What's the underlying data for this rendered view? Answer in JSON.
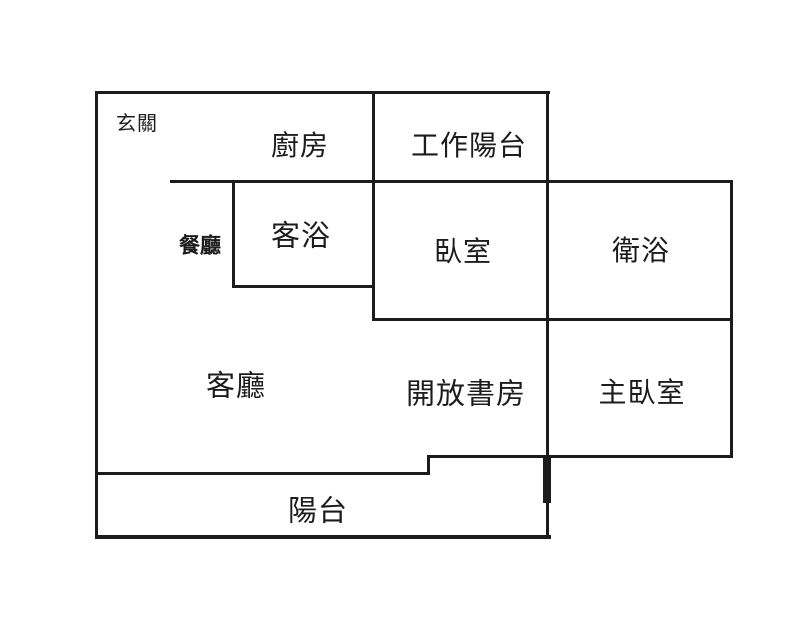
{
  "title": "apartment-floor-plan",
  "colors": {
    "wall": "#1c1c1c",
    "text": "#1c1c1c",
    "background": "#ffffff"
  },
  "rooms": {
    "entryway": "玄關",
    "kitchen": "廚房",
    "work_balcony": "工作陽台",
    "dining_room": "餐廳",
    "guest_bathroom": "客浴",
    "bedroom": "臥室",
    "bathroom": "衛浴",
    "living_room": "客廳",
    "open_study": "開放書房",
    "master_bedroom": "主臥室",
    "balcony": "陽台"
  }
}
